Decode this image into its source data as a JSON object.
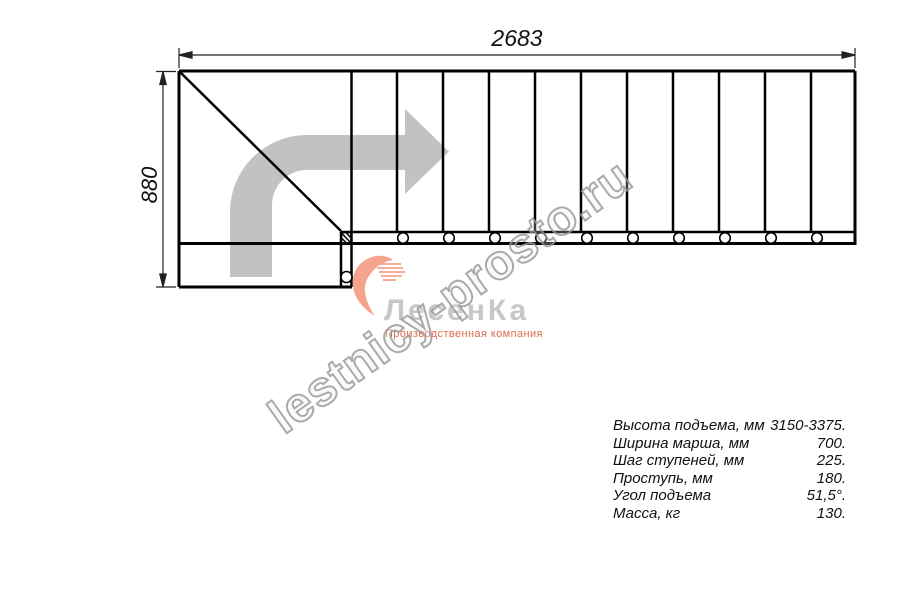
{
  "drawing": {
    "type": "staircase-plan-top-view",
    "top_dimension": "2683",
    "left_dimension": "880",
    "tread_count_straight_run": 11,
    "fastener_circle_count": 11
  },
  "watermark": {
    "text": "lestnicy-prosto.ru"
  },
  "logo": {
    "name": "ЛесенКа",
    "tagline": "Производственная компания",
    "icon": "stair-heart-swoosh-icon"
  },
  "icons": {
    "direction_arrow": "curved-right-direction-arrow",
    "fasteners": "bolt-circles",
    "post": "hatched-post-square"
  },
  "specs": {
    "rows": [
      {
        "label": "Высота подъема, мм",
        "value": "3150-3375."
      },
      {
        "label": "Ширина марша, мм",
        "value": "700."
      },
      {
        "label": "Шаг ступеней, мм",
        "value": "225."
      },
      {
        "label": "Проступь, мм",
        "value": "180."
      },
      {
        "label": "Угол подъема",
        "value": "51,5°."
      },
      {
        "label": "Масса, кг",
        "value": "130."
      }
    ]
  },
  "colors": {
    "line": "#000000",
    "dimension_line": "#222222",
    "direction_arrow": "#c2c2c2",
    "watermark_outline": "#969696",
    "logo_accent": "#f4a48c",
    "logo_text": "#c7c7c7",
    "logo_tagline_text": "#e06a50"
  }
}
